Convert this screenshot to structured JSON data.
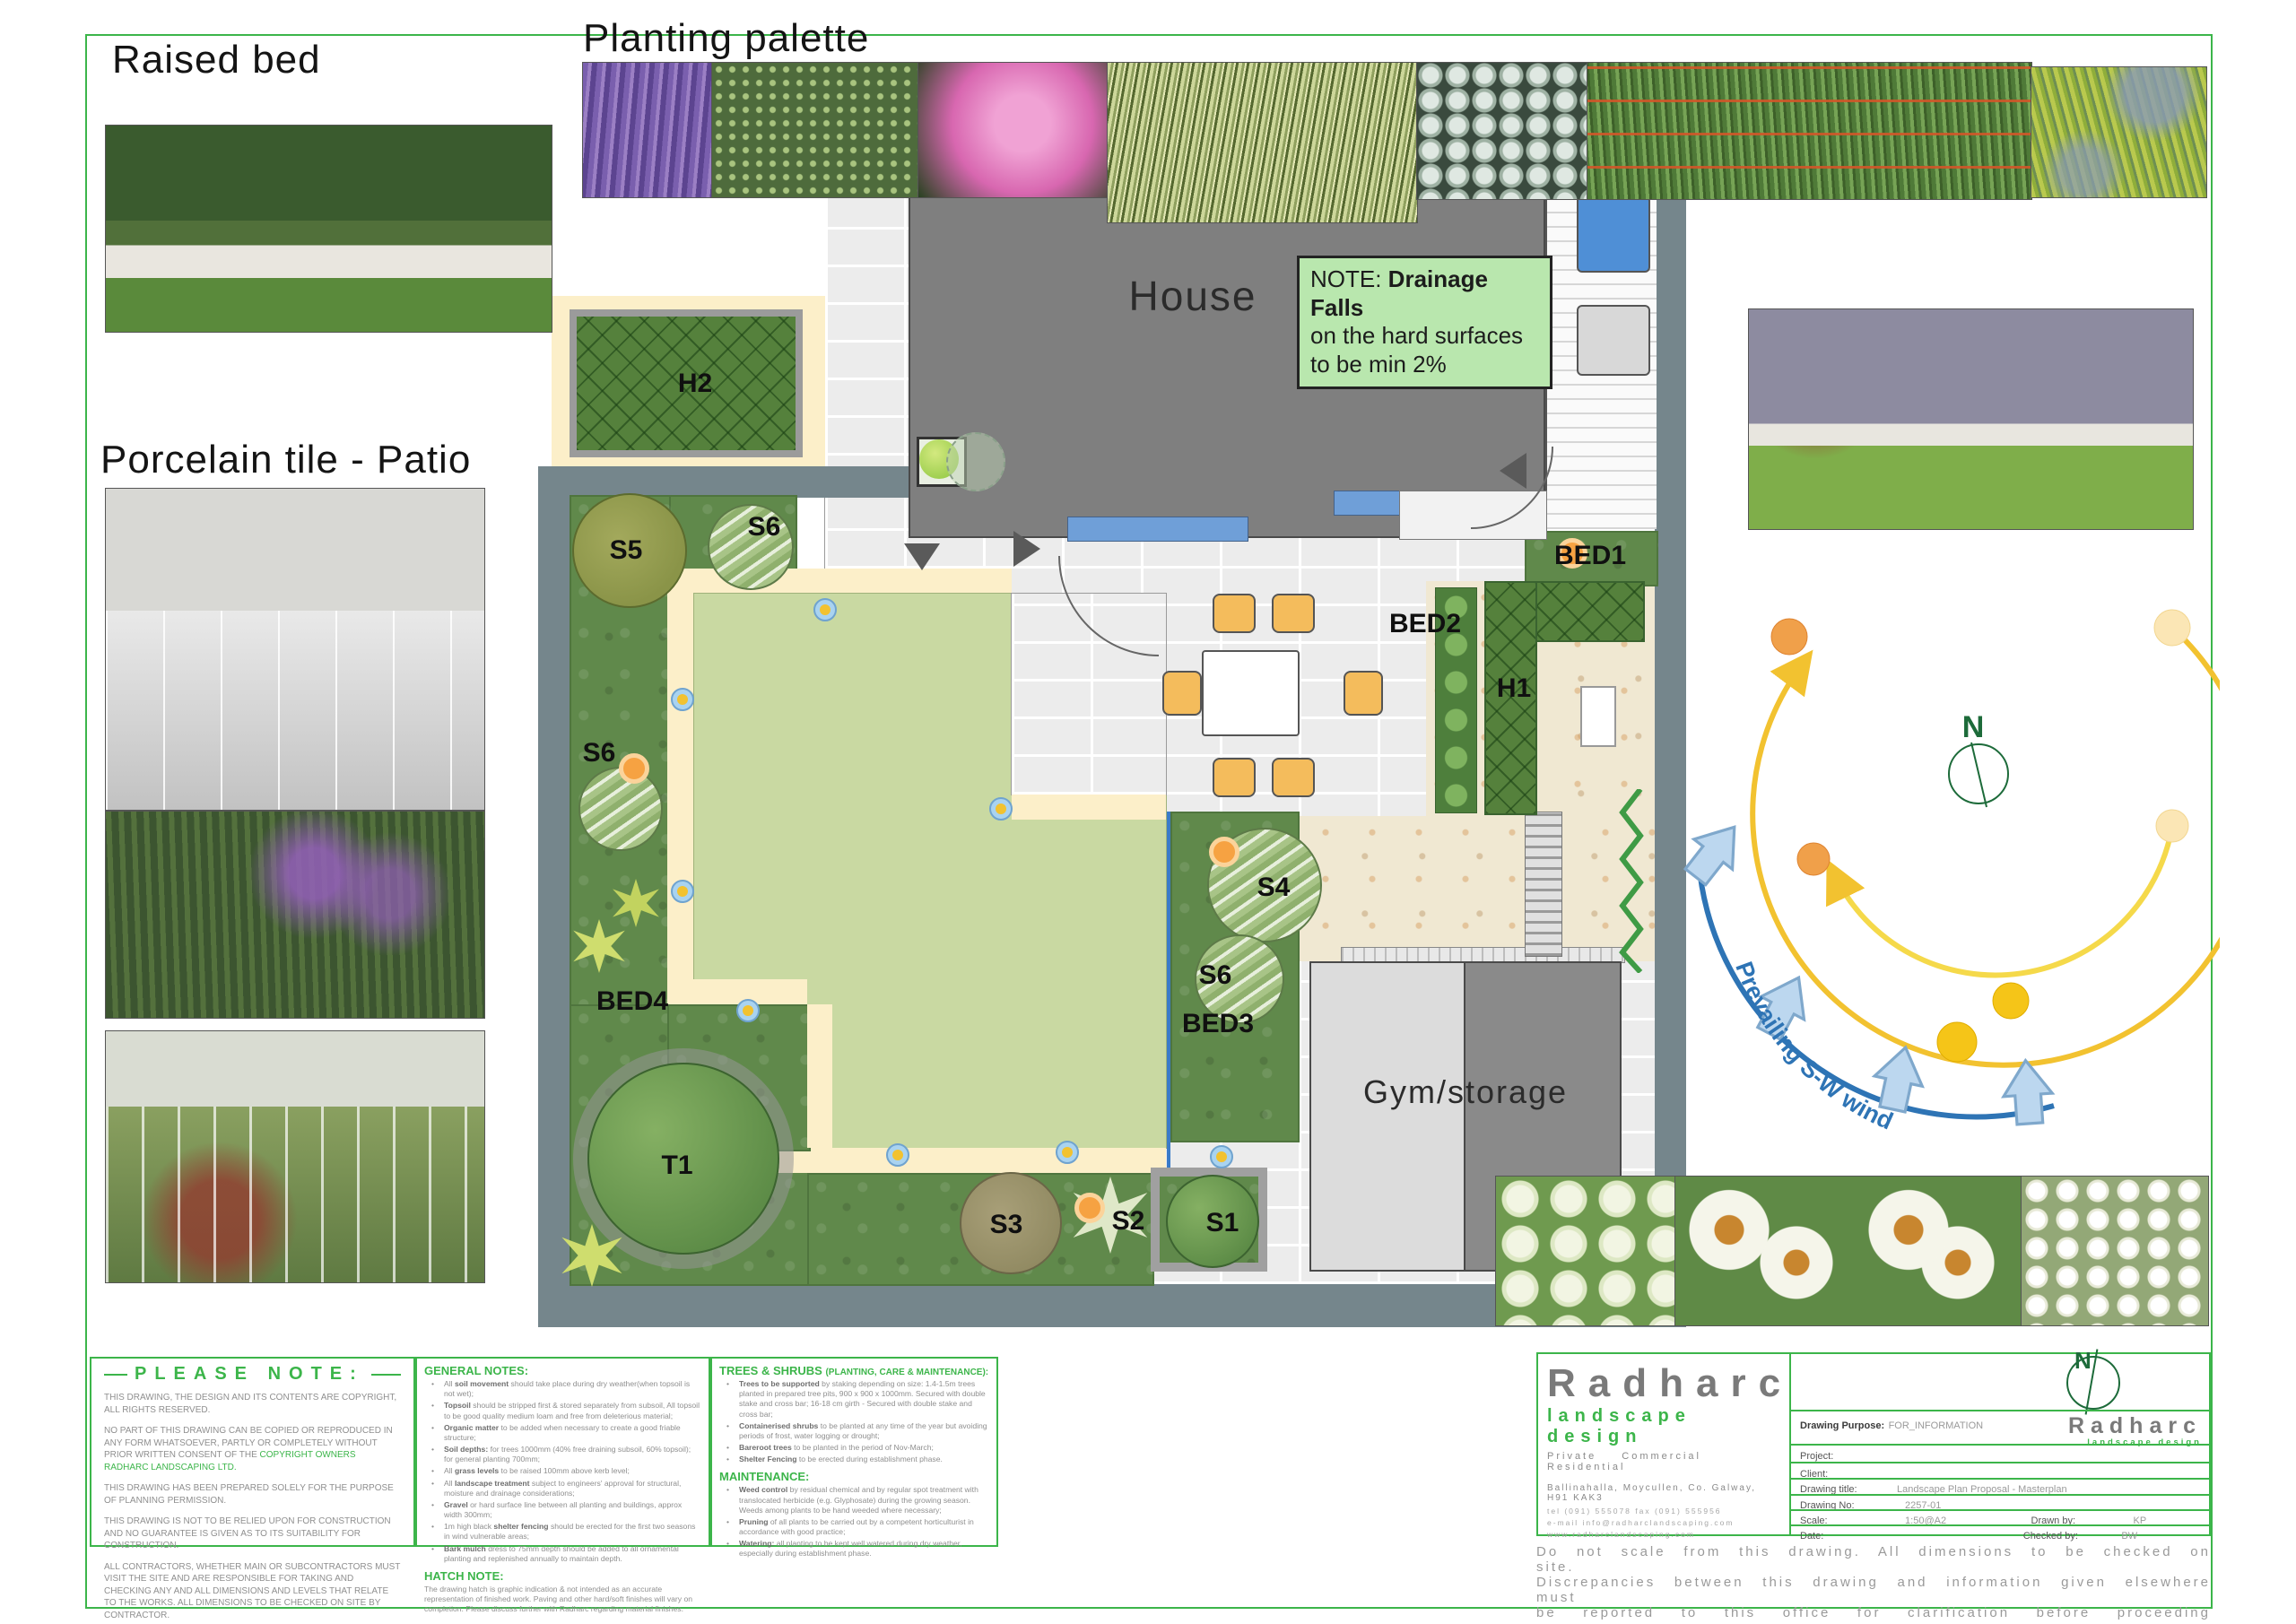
{
  "headings": {
    "raised_bed": "Raised bed",
    "planting_palette": "Planting palette",
    "porcelain_patio": "Porcelain tile - Patio"
  },
  "plan": {
    "labels": {
      "house": "House",
      "gym": "Gym/storage",
      "h1": "H1",
      "h2": "H2",
      "bed1": "BED1",
      "bed2": "BED2",
      "bed3": "BED3",
      "bed4": "BED4",
      "s1": "S1",
      "s2": "S2",
      "s3": "S3",
      "s4": "S4",
      "s5": "S5",
      "s6_top": "S6",
      "s6_left": "S6",
      "s6_mid": "S6",
      "t1": "T1"
    },
    "note": {
      "prefix": "NOTE: ",
      "bold": "Drainage Falls",
      "line2": "on the hard surfaces",
      "line3": "to be min 2%"
    }
  },
  "diagram": {
    "north": "N",
    "wind_label": "Prevailing S-W wind"
  },
  "photos": {
    "raised_bed": "Raised bed with buddha statue",
    "salvia": "Purple salvia",
    "shrub": "Evergreen shrub",
    "nerine": "Pink nerine",
    "carex": "Variegated carex grass",
    "brunnera": "Silver brunnera foliage",
    "grasses_chair": "Ornamental grasses with orange wire chair",
    "ferns": "Golden ferns",
    "patio": "Porcelain tile patio",
    "garden_borders": "Mixed border planting",
    "garden_patio": "Courtyard planting",
    "garden_wall": "Garden with purple wall",
    "hydrangea": "White hydrangea",
    "echinacea": "White echinacea",
    "candytuft": "White candytuft"
  },
  "notes": {
    "please": {
      "title": "PLEASE NOTE:",
      "paragraphs": [
        {
          "t": "THIS DRAWING, THE DESIGN AND ITS CONTENTS ARE COPYRIGHT, ALL RIGHTS RESERVED."
        },
        {
          "t": "NO PART OF THIS DRAWING CAN BE COPIED OR REPRODUCED IN ANY FORM WHATSOEVER, PARTLY OR COMPLETELY WITHOUT PRIOR WRITTEN CONSENT OF THE ",
          "g": "COPYRIGHT OWNERS RADHARC LANDSCAPING LTD."
        },
        {
          "t": "THIS DRAWING HAS BEEN PREPARED SOLELY FOR THE PURPOSE OF PLANNING PERMISSION."
        },
        {
          "t": "THIS DRAWING IS NOT TO BE RELIED UPON FOR CONSTRUCTION AND NO GUARANTEE IS GIVEN AS TO ITS SUITABILITY FOR CONSTRUCTION."
        },
        {
          "t": "ALL CONTRACTORS, WHETHER MAIN OR SUBCONTRACTORS MUST VISIT THE SITE AND ARE RESPONSIBLE FOR TAKING AND CHECKING ANY AND ALL DIMENSIONS AND LEVELS THAT RELATE TO THE WORKS. ALL DIMENSIONS TO BE CHECKED ON SITE BY CONTRACTOR."
        }
      ]
    },
    "general": {
      "title": "GENERAL NOTES:",
      "items": [
        {
          "pre": "All ",
          "b": "soil movement",
          "t": " should take place during dry weather(when topsoil is not wet);"
        },
        {
          "b": "Topsoil",
          "t": " should be stripped first & stored separately  from subsoil, All topsoil to be good quality medium loam and free from deleterious material;"
        },
        {
          "b": "Organic matter",
          "t": " to be added when necessary to create a good friable structure;"
        },
        {
          "b": "Soil depths:",
          "t": " for trees 1000mm (40% free draining subsoil, 60% topsoil); for general planting 700mm;"
        },
        {
          "pre": "All ",
          "b": "grass levels",
          "t": " to be raised 100mm above kerb level;"
        },
        {
          "pre": "All ",
          "b": "landscape treatment",
          "t": " subject to engineers' approval for structural, moisture and drainage considerations;"
        },
        {
          "b": "Gravel",
          "t": " or hard surface line between all planting and buildings, approx width 300mm;"
        },
        {
          "pre": "1m high black ",
          "b": "shelter fencing",
          "t": " should be erected for the first two seasons in wind vulnerable areas;"
        },
        {
          "b": "Bark mulch",
          "t": " dress to 75mm depth should be added to all ornamental planting and replenished annually to maintain depth."
        }
      ],
      "hatch_title": "HATCH NOTE:",
      "hatch_text": "The drawing hatch is graphic indication & not intended as an accurate representation of finished work. Paving and other hard/soft finishes will vary on completion. Please discuss further with Radharc regarding material finishes."
    },
    "trees": {
      "title": "TREES & SHRUBS ",
      "subtitle": "(PLANTING, CARE & MAINTENANCE):",
      "items": [
        {
          "b": "Trees to be supported",
          "t": " by staking depending on size: 1.4-1.5m trees planted in prepared tree pits, 900 x 900 x 1000mm. Secured with double stake and cross bar; 16-18 cm girth - Secured with double stake and cross bar;"
        },
        {
          "b": "Containerised shrubs",
          "t": " to be planted at any time of the year but avoiding periods of frost, water logging or drought;"
        },
        {
          "b": "Bareroot trees",
          "t": " to be planted in the period of Nov-March;"
        },
        {
          "b": "Shelter Fencing",
          "t": " to be erected during establishment phase."
        }
      ],
      "maintenance_title": "MAINTENANCE:",
      "maintenance_items": [
        {
          "b": "Weed control",
          "t": " by residual chemical and by regular spot treatment with translocated herbicide (e.g. Glyphosate) during the growing season. Weeds among plants to be hand weeded where necessary;"
        },
        {
          "b": "Pruning",
          "t": " of all plants to be carried out by a competent horticulturist in accordance with good practice;"
        },
        {
          "b": "Watering:",
          "t": " all planting to be kept well watered during dry weather, especially during establishment phase."
        }
      ]
    }
  },
  "titleblock": {
    "company": {
      "name": "Radharc",
      "tagline": "landscape design",
      "sectors": "Private Commercial Residential",
      "address": "Ballinahalla, Moycullen, Co. Galway, H91 KAK3",
      "phone": "tel (091) 555078    fax (091) 555956",
      "email": "e-mail  info@radharclandscaping.com",
      "web": "www.radharclandscaping.com"
    },
    "logo_small": {
      "name": "Radharc",
      "tagline": "landscape design"
    },
    "north": "N",
    "fields": {
      "purpose_label": "Drawing Purpose:",
      "purpose": "FOR_INFORMATION",
      "project_label": "Project:",
      "project": "",
      "client_label": "Client:",
      "client": "",
      "title_label": "Drawing title:",
      "title": "Landscape Plan Proposal - Masterplan",
      "no_label": "Drawing No:",
      "no": "2257-01",
      "scale_label": "Scale:",
      "scale": "1:50@A2",
      "date_label": "Date:",
      "date": "",
      "drawn_label": "Drawn by:",
      "drawn": "KP",
      "checked_label": "Checked by:",
      "checked": "BW"
    },
    "disclaimer_lines": [
      {
        "t": "Do not scale from this drawing.  All dimensions to be checked on site."
      },
      {
        "t": "Discrepancies between this drawing and information given elsewhere must"
      },
      {
        "t": "be reported to this office for clarification before proceeding"
      }
    ]
  }
}
